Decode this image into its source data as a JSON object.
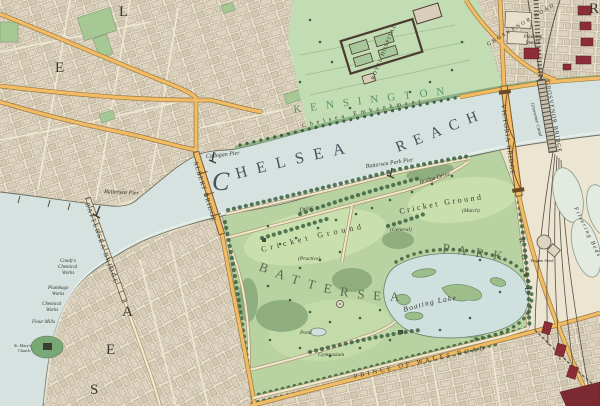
{
  "palette": {
    "paper_cream": "#ebe2cb",
    "water": "#d5e2df",
    "park_green": "#b8d2a2",
    "open_ground_green": "#c9e0ae",
    "woodland_green": "#8aab7c",
    "road_orange": "#f2bc64",
    "maroon_building": "#8c2e38",
    "railway_grey": "#565046",
    "district_text_green": "#4c8c57"
  },
  "river": {
    "chelsea_initial": "C",
    "chelsea_rest": "HELSEA",
    "reach": "REACH",
    "embankment": "Chelsea Embankment",
    "pier_battersea": "Battersea Pier",
    "pier_cadogan": "Cadogan Pier",
    "pier_park": "Battersea Park Pier",
    "grosvenor_canal": "Grosvenor Canal"
  },
  "bridges": {
    "battersea": "BATTERSEA BRIDGE",
    "albert": "ALBERT BRIDGE",
    "victoria": "VICTORIA BRIDGE",
    "grosvenor": "GROSVENOR BRIDGE"
  },
  "districts": {
    "kensington": "KENSINGTON",
    "letters": {
      "e1": "E",
      "l1": "L",
      "r1": "R",
      "s1": "S",
      "e2": "E",
      "a1": "A"
    }
  },
  "park": {
    "name_line1": "BATTERSEA",
    "name_line2": "PARK",
    "cricket_west": "Cricket Ground",
    "cricket_east": "Cricket Ground",
    "qual_practice": "(Practice)",
    "qual_general": "(General)",
    "qual_match": "(Match)",
    "boating_lake": "Boating Lake",
    "pond": "Pond",
    "gymnasium": "Gymnasium",
    "drive": "Drive",
    "bridge_drive": "Bridge Drive"
  },
  "roads": {
    "grosvenor_road": "GROSVENOR ROAD",
    "prince_of_wales": "PRINCE OF WALES ROAD",
    "east_road": "ROAD"
  },
  "places": {
    "royal_hospital": "ROYAL HOSPITAL",
    "pumping_l1": "Pumping",
    "pumping_l2": "Station",
    "filtering_beds": "Filtering Beds",
    "engine_shed": "Engine Shed",
    "condys_l1": "Condy's",
    "condys_l2": "Chemical",
    "condys_l3": "Works",
    "plumbago_l1": "Plumbago",
    "plumbago_l2": "Works",
    "chemical_l1": "Chemical",
    "chemical_l2": "Works",
    "flour_mills": "Flour Mills",
    "stmarys_l1": "St. Mary's",
    "stmarys_l2": "Church"
  }
}
